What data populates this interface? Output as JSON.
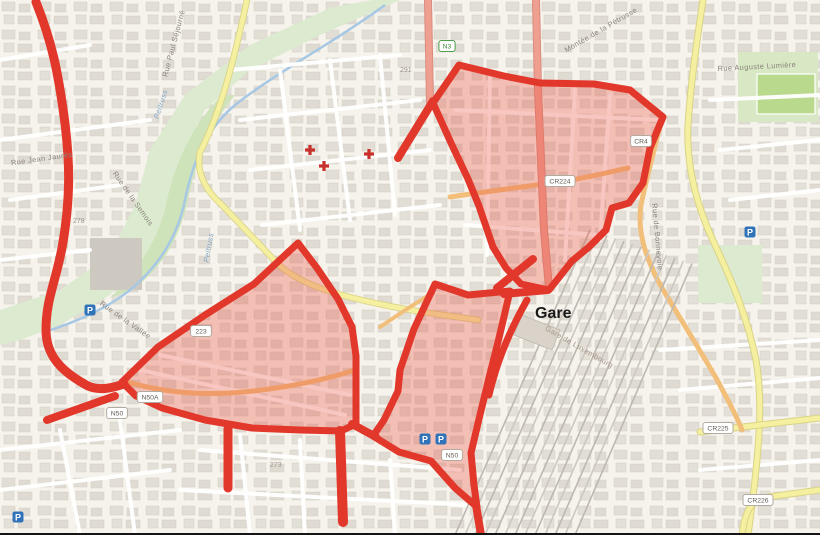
{
  "map": {
    "colors": {
      "background": "#f6f3ec",
      "building": "#dcd7cf",
      "green_area": "#d8e8c4",
      "pitch_green": "#b9d98c",
      "water": "#a7c8e4",
      "road_white": "#ffffff",
      "road_yellow": "#f5f0a0",
      "road_orange": "#f2bf7a",
      "road_primary": "#ef9f90",
      "railway": "#bdb8b0",
      "overlay_fill": "rgba(238,84,71,0.33)",
      "overlay_stroke": "#e2382c",
      "parking_blue": "#3073b8",
      "cross_red": "#c9302c"
    },
    "gare_label": "Gare",
    "street_labels": [
      {
        "text": "Peitruss",
        "x": 163,
        "y": 105,
        "rotate": -72,
        "color": "#7fa6c8",
        "italic": true
      },
      {
        "text": "Peitruss",
        "x": 211,
        "y": 248,
        "rotate": -80,
        "color": "#7fa6c8",
        "italic": true
      },
      {
        "text": "Rue Paul Séjourné",
        "x": 176,
        "y": 44,
        "rotate": -75,
        "color": "#8a837b",
        "italic": false
      },
      {
        "text": "Montée de la Pétrusse",
        "x": 602,
        "y": 32,
        "rotate": -30,
        "color": "#8a837b",
        "italic": false
      },
      {
        "text": "Rue Auguste Lumière",
        "x": 757,
        "y": 69,
        "rotate": -3,
        "color": "#8a837b",
        "italic": false
      },
      {
        "text": "Rue Jean Jaurès",
        "x": 42,
        "y": 161,
        "rotate": -8,
        "color": "#8a837b",
        "italic": false
      },
      {
        "text": "Rue de la Semois",
        "x": 131,
        "y": 200,
        "rotate": 55,
        "color": "#8a837b",
        "italic": false
      },
      {
        "text": "Rue de la Vallée",
        "x": 124,
        "y": 322,
        "rotate": 35,
        "color": "#8a837b",
        "italic": false
      },
      {
        "text": "Rue de Bonnevoie",
        "x": 655,
        "y": 237,
        "rotate": 85,
        "color": "#8a837b",
        "italic": false
      },
      {
        "text": "Gare de Luxembourg",
        "x": 578,
        "y": 349,
        "rotate": 30,
        "color": "#a39386",
        "italic": false
      }
    ],
    "elevation_markers": [
      {
        "text": "291",
        "x": 400,
        "y": 72
      },
      {
        "text": "278",
        "x": 73,
        "y": 223
      },
      {
        "text": "273",
        "x": 270,
        "y": 467
      }
    ],
    "road_badges": [
      {
        "ref": "N3",
        "x": 447,
        "y": 46,
        "style": "green"
      },
      {
        "ref": "CR224",
        "x": 560,
        "y": 181,
        "style": "white"
      },
      {
        "ref": "CR4",
        "x": 641,
        "y": 141,
        "style": "white"
      },
      {
        "ref": "223",
        "x": 201,
        "y": 331,
        "style": "white"
      },
      {
        "ref": "N50A",
        "x": 150,
        "y": 397,
        "style": "white"
      },
      {
        "ref": "N50",
        "x": 117,
        "y": 413,
        "style": "white"
      },
      {
        "ref": "N50",
        "x": 452,
        "y": 455,
        "style": "white"
      },
      {
        "ref": "CR225",
        "x": 718,
        "y": 428,
        "style": "white"
      },
      {
        "ref": "CR226",
        "x": 758,
        "y": 500,
        "style": "white"
      }
    ],
    "parking_icons": [
      {
        "x": 90,
        "y": 310
      },
      {
        "x": 425,
        "y": 439
      },
      {
        "x": 441,
        "y": 439
      },
      {
        "x": 18,
        "y": 517
      },
      {
        "x": 750,
        "y": 232
      }
    ],
    "medical_cross_icons": [
      {
        "x": 310,
        "y": 150
      },
      {
        "x": 324,
        "y": 166
      },
      {
        "x": 369,
        "y": 154
      }
    ],
    "overlay": {
      "zones": [
        {
          "name": "upper-station-quarter",
          "path": "M459,65 L504,76 L540,83 L594,84 L630,90 L663,117 L650,148 L643,183 L629,203 L612,208 L606,230 L589,247 L572,261 L549,290 L521,284 L506,268 L493,247 L479,206 L468,179 L451,143 L433,103 Z"
        },
        {
          "name": "lower-left-quarter",
          "path": "M122,382 L158,347 L205,315 L254,284 L298,243 L317,268 L338,299 L352,327 L356,356 L356,424 L341,431 L300,430 L252,428 L205,420 L162,408 L136,396 Z"
        },
        {
          "name": "lower-right-quarter",
          "path": "M435,284 L468,295 L510,291 L499,338 L489,378 L479,419 L471,453 L474,485 L477,507 L455,488 L431,461 L399,452 L373,436 L384,420 L398,391 L400,370 L414,329 Z"
        }
      ],
      "connectors": [
        {
          "path": "M36,2 C52,42 58,72 64,116 C70,160 71,198 62,248 C55,284 46,300 46,330 C46,356 62,372 88,386 C100,391 112,388 124,384",
          "w": 9
        },
        {
          "path": "M433,101 L398,158",
          "w": 8
        },
        {
          "path": "M548,290 L504,294",
          "w": 8
        },
        {
          "path": "M533,259 L497,288",
          "w": 8
        },
        {
          "path": "M228,429 L228,488",
          "w": 9
        },
        {
          "path": "M340,431 L343,522",
          "w": 10
        },
        {
          "path": "M352,424 L376,437",
          "w": 8
        },
        {
          "path": "M115,396 L47,420",
          "w": 8
        },
        {
          "path": "M476,505 L481,535",
          "w": 8
        },
        {
          "path": "M527,300 C510,330 497,360 489,395",
          "w": 7
        }
      ]
    }
  }
}
